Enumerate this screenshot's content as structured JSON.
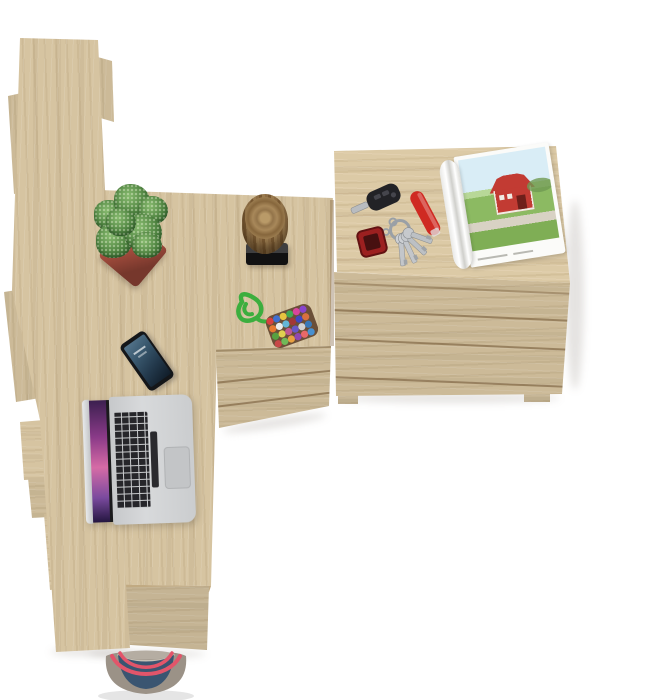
{
  "meta": {
    "scene_label": "Top-down product photo of a light-oak home office desk set on a white floor",
    "canvas": {
      "width": 648,
      "height": 700
    },
    "background_color": "#ffffff"
  },
  "palette": {
    "wood_base": "#d6c4a1",
    "wood_grain_dark": "#a8906a",
    "wood_front_shade": "#c8b48c",
    "seam": "#80623c",
    "floor": "#ffffff"
  },
  "furniture": {
    "bookshelf": {
      "label": "ladder bookshelf seen from above, stepped slabs"
    },
    "desk": {
      "label": "L-shaped oak desk surface with front panel"
    },
    "pedestal": {
      "label": "under-desk drawer pedestal",
      "drawer_count": 2
    },
    "chest": {
      "label": "oak chest of drawers",
      "drawer_count": 3
    }
  },
  "objects": {
    "plant": {
      "label": "spiky succulent in square terracotta planter",
      "pot_color": "#a94f3f",
      "foliage_color": "#4e8340"
    },
    "stump": {
      "label": "decorative wood stump on black stand",
      "bark_color": "#8a6a42",
      "base_color": "#1f1f21"
    },
    "pompom": {
      "label": "green paracord keychain with multicolor felt-ball pouch",
      "cord_color": "#3cae3e",
      "ball_colors": [
        "#d84040",
        "#3f6fd0",
        "#e8c440",
        "#41a853",
        "#d8459c",
        "#8844cc",
        "#e87830",
        "#ececec",
        "#64b6d8",
        "#a23838",
        "#4048c0",
        "#d87040",
        "#58a040",
        "#e0d050",
        "#c05890",
        "#6858c8",
        "#d0d0d0",
        "#3878b8",
        "#c84848",
        "#70b858",
        "#e8a040",
        "#9048b0",
        "#e86868",
        "#4890d0"
      ]
    },
    "car_fob": {
      "label": "black car key with remote buttons",
      "color": "#222226"
    },
    "knife": {
      "label": "red pocket knife",
      "color": "#cf2a22"
    },
    "keyring": {
      "label": "key ring with four silver keys",
      "metal_color": "#c3c6ca"
    },
    "red_fob": {
      "label": "red square key fob on chain",
      "color": "#9c2020"
    },
    "phone": {
      "label": "smartphone with dark blue lock screen",
      "body_color": "#141619"
    },
    "laptop": {
      "label": "open silver laptop with purple wallpaper",
      "body_color": "#d3d5d7",
      "screen_accent": "#d66ba6"
    },
    "magazine": {
      "label": "open magazine showing red barn in green field",
      "barn_color": "#c23b33",
      "sky_color": "#d9edf6",
      "field_color": "#8cba62"
    },
    "bag": {
      "label": "blue canvas tote bag with coral rope straps",
      "canvas_color": "#9b9287",
      "denim_color": "#3a5571",
      "strap_color": "#e2556a"
    }
  }
}
